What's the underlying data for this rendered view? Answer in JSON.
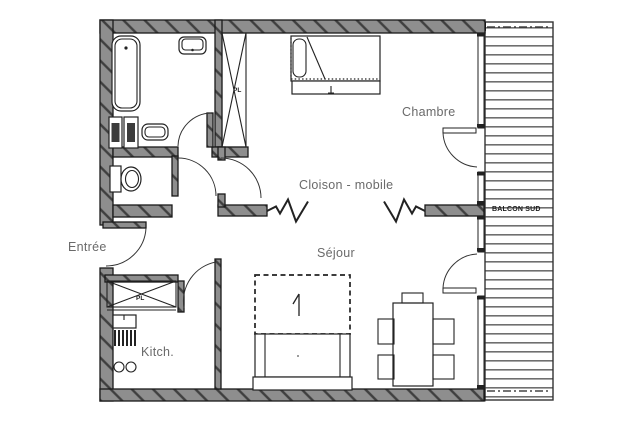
{
  "plan": {
    "labels": {
      "chambre": "Chambre",
      "cloison_mobile": "Cloison - mobile",
      "sejour": "Séjour",
      "entree": "Entrée",
      "kitchen": "Kitch.",
      "balcon_sud": "BALCON SUD",
      "closet_pl_bathroom": "PL",
      "closet_pl_entry": "PL"
    },
    "colors": {
      "background": "#ffffff",
      "wall_fill": "#8e8e8e",
      "wall_hatch": "#3f3f3f",
      "outline": "#1a1a1a",
      "room_label": "#6a6a6a",
      "balcony_label": "#1d1d1d"
    }
  }
}
